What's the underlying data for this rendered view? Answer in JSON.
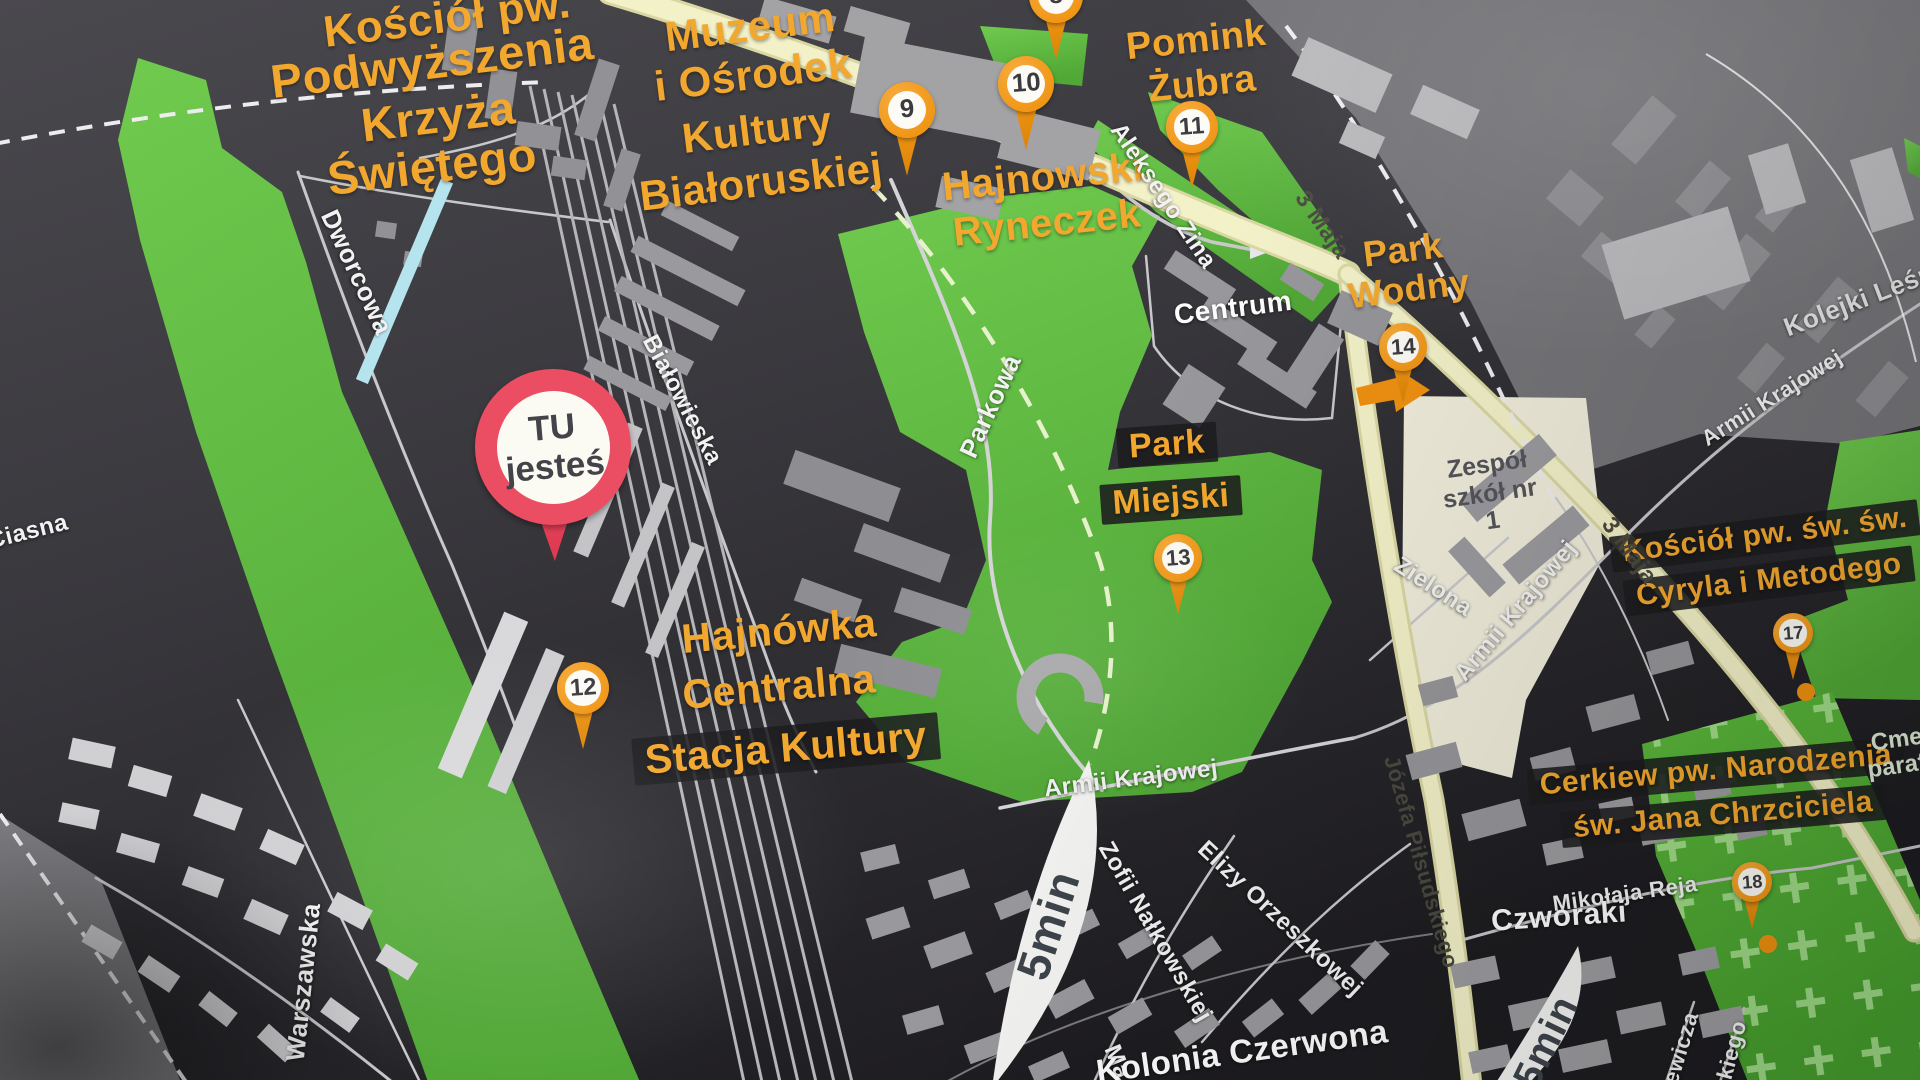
{
  "map": {
    "you_are_here": {
      "line1": "TU",
      "line2": "jesteś"
    },
    "pois": {
      "church_holy_cross": {
        "l0": "Kościół pw.",
        "l1": "Podwyższenia",
        "l2": "Krzyża",
        "l3": "Świętego"
      },
      "museum": {
        "l0": "Muzeum",
        "l1": "i Ośrodek",
        "l2": "Kultury",
        "l3": "Białoruskiej"
      },
      "bison_monument": {
        "l0": "Pomink",
        "l1": "Żubra"
      },
      "hajnowski_ryneczek": {
        "l0": "Hajnowski",
        "l1": "Ryneczek"
      },
      "park_wodny": {
        "l0": "Park",
        "l1": "Wodny"
      },
      "park_miejski": {
        "l0": "Park",
        "l1": "Miejski"
      },
      "stacja_kultury": {
        "l0": "Hajnówka",
        "l1": "Centralna",
        "l2": "Stacja Kultury"
      },
      "kosciol_cyryla": {
        "l0": "Kościół pw. św. św.",
        "l1": "Cyryla i Metodego"
      },
      "cerkiew_narodzenia": {
        "l0": "Cerkiew pw. Narodzenia",
        "l1": "św. Jana Chrzciciela"
      }
    },
    "markers": {
      "m8": "8",
      "m9": "9",
      "m10": "10",
      "m11": "11",
      "m12": "12",
      "m13": "13",
      "m14": "14",
      "m17": "17",
      "m18": "18"
    },
    "streets": {
      "dworcowa": "Dworcowa",
      "bialowieska": "Białowieska",
      "parkowa": "Parkowa",
      "ciasna": "Ciasna",
      "warszawska": "Warszawska",
      "aleksego_zina": "Aleksego Zina",
      "maja3_upper": "3 Maja",
      "maja3_lower": "3 Maja",
      "pilsudskiego": "Józefa Piłsudskiego",
      "armii_krajowej_south": "Armii Krajowej",
      "armii_krajowej_east": "Armii Krajowej",
      "armii_krajowej_ne": "Armii Krajowej",
      "zielona": "Zielona",
      "mikolaja_reja": "Mikołaja Reja",
      "zofii_nalkowskiej": "Zofii Nałkowskiej",
      "elizy_orzeszkowej": "Elizy Orzeszkowej",
      "kolejki_lesne": "Kolejki Leśne",
      "frag_ewicza": "ewicza",
      "frag_kiego": "kiego",
      "frag_ma": "Ma"
    },
    "places": {
      "centrum": "Centrum",
      "czworaki": "Czworaki",
      "kolonia_czerwona": "Kolonia Czerwona",
      "school_l0": "Zespół",
      "school_l1": "szkół nr",
      "school_l2": "1",
      "cemetery_l0": "Cmen",
      "cemetery_l1": "parafi"
    },
    "walk_times": {
      "b1": "5min",
      "b2": "5min"
    },
    "colors": {
      "poi_label_orange": "#F2A72E",
      "marker_orange": "#F0920E",
      "you_are_here_red": "#EB4E63",
      "park_green": "#63BD41",
      "road_yellow": "#F3F1C8",
      "cemetery_cross_green": "#A8E090",
      "map_dark": "#39383D"
    }
  }
}
